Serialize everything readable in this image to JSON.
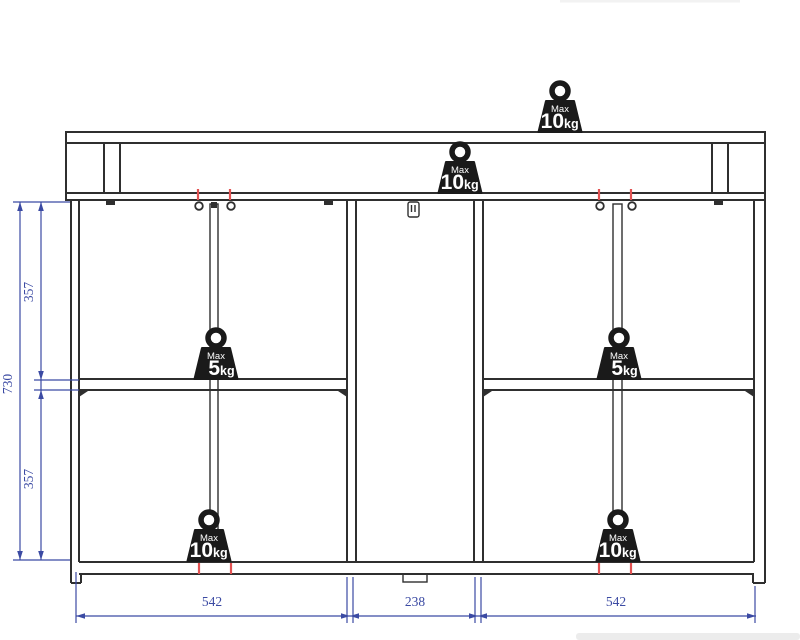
{
  "drawing": {
    "kind": "furniture-dimension-diagram"
  },
  "weights": [
    {
      "location": "top-board",
      "max_label": "Max",
      "amount": "10",
      "unit": "kg"
    },
    {
      "location": "carcass-top",
      "max_label": "Max",
      "amount": "10",
      "unit": "kg"
    },
    {
      "location": "left-middle-shelf",
      "max_label": "Max",
      "amount": "5",
      "unit": "kg"
    },
    {
      "location": "right-middle-shelf",
      "max_label": "Max",
      "amount": "5",
      "unit": "kg"
    },
    {
      "location": "left-bottom",
      "max_label": "Max",
      "amount": "10",
      "unit": "kg"
    },
    {
      "location": "right-bottom",
      "max_label": "Max",
      "amount": "10",
      "unit": "kg"
    }
  ],
  "dimensions": {
    "total_height": "730",
    "upper_section_height": "357",
    "lower_section_height": "357",
    "left_section_width": "542",
    "middle_section_width": "238",
    "right_section_width": "542"
  },
  "colors": {
    "line": "#2f2f2f",
    "dimension_blue": "#3b4aa3",
    "marker_red": "#e25252",
    "weight_fill": "#1a1a1a"
  }
}
